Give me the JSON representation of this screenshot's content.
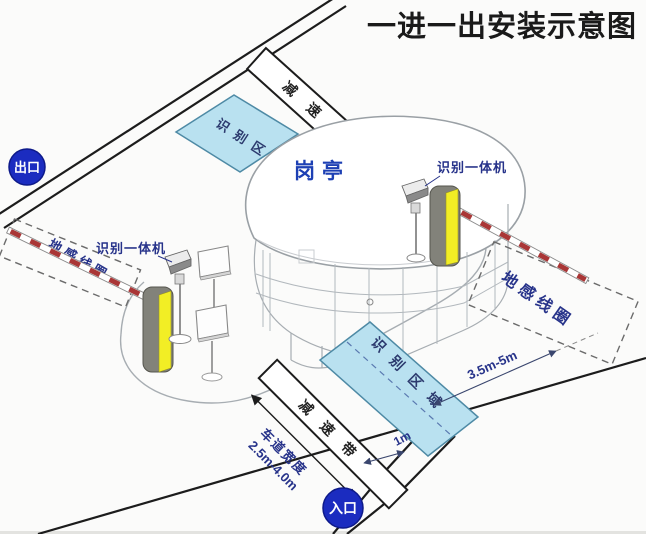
{
  "title": "一进一出安装示意图",
  "badges": {
    "exit": "出口",
    "entrance": "入口"
  },
  "booth_label": "岗亭",
  "zones": {
    "recognition_top": "识别区域",
    "recognition_bottom": "识别区域",
    "coil_left": "地感线圈",
    "coil_right": "地感线圈"
  },
  "speed_bumps": {
    "top": "减速带",
    "bottom": "减速带"
  },
  "devices": {
    "reader_left": "识别一体机",
    "reader_right": "识别一体机"
  },
  "dimensions": {
    "lane_width_label": "车道宽度",
    "lane_width_value": "2.5m-4.0m",
    "area_to_coil": "3.5m-5m",
    "bump_to_area": "1m"
  },
  "colors": {
    "zone_fill": "#b9e1f0",
    "zone_stroke": "#4e8aa5",
    "badge_blue": "#1b2cc0",
    "label_navy": "#27338a",
    "machine_yellow": "#f2ee25",
    "machine_gray": "#82827a",
    "arm_red": "#a93636",
    "line_black": "#1c1c1c",
    "booth_blue": "#1d40b4"
  }
}
